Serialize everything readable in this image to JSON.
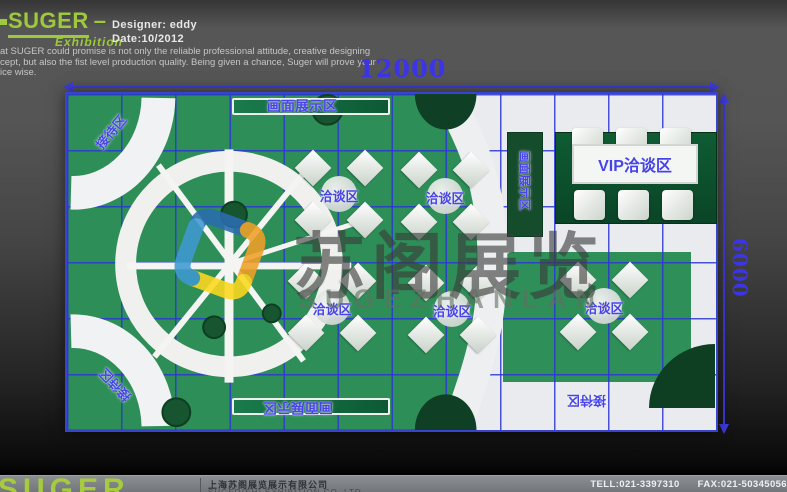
{
  "header": {
    "brand": "SUGER",
    "brand_dash": "–",
    "brand_sub": "Exhibition",
    "designer": "Designer: eddy",
    "date": "Date:10/2012",
    "intro": [
      "at SUGER could promise is not only the reliable professional attitude, creative designing",
      "cept, but also the fist level production quality. Being given a chance, Suger will prove your",
      "ice wise."
    ]
  },
  "plan": {
    "dimensions": {
      "width_label": "12000",
      "height_label": "6000"
    },
    "areas": {
      "reception": "接待区",
      "display": "画面展示区",
      "media_wall": "画面展示区",
      "negotiation": "洽谈区",
      "vip": "VIP洽谈区"
    }
  },
  "watermark": {
    "text_cn": "苏阁展览",
    "text_en": "SUGEZHANLAN"
  },
  "footer": {
    "logo": "SUGER",
    "company_cn": "上海苏阁展览展示有限公司",
    "company_en": "SUGER(SH) EXHIBITION CO.,LTD",
    "tel": "TELL:021-3397310",
    "fax": "FAX:021-50345056"
  },
  "colors": {
    "brand_green": "#9dc93a",
    "dimension_blue": "#3c35e8",
    "label_blue": "#4643e8",
    "carpet_green": "#2e8e58",
    "dark_green": "#14502e",
    "floor_white": "#e9ebee",
    "footer_grey": "#7e8286"
  }
}
